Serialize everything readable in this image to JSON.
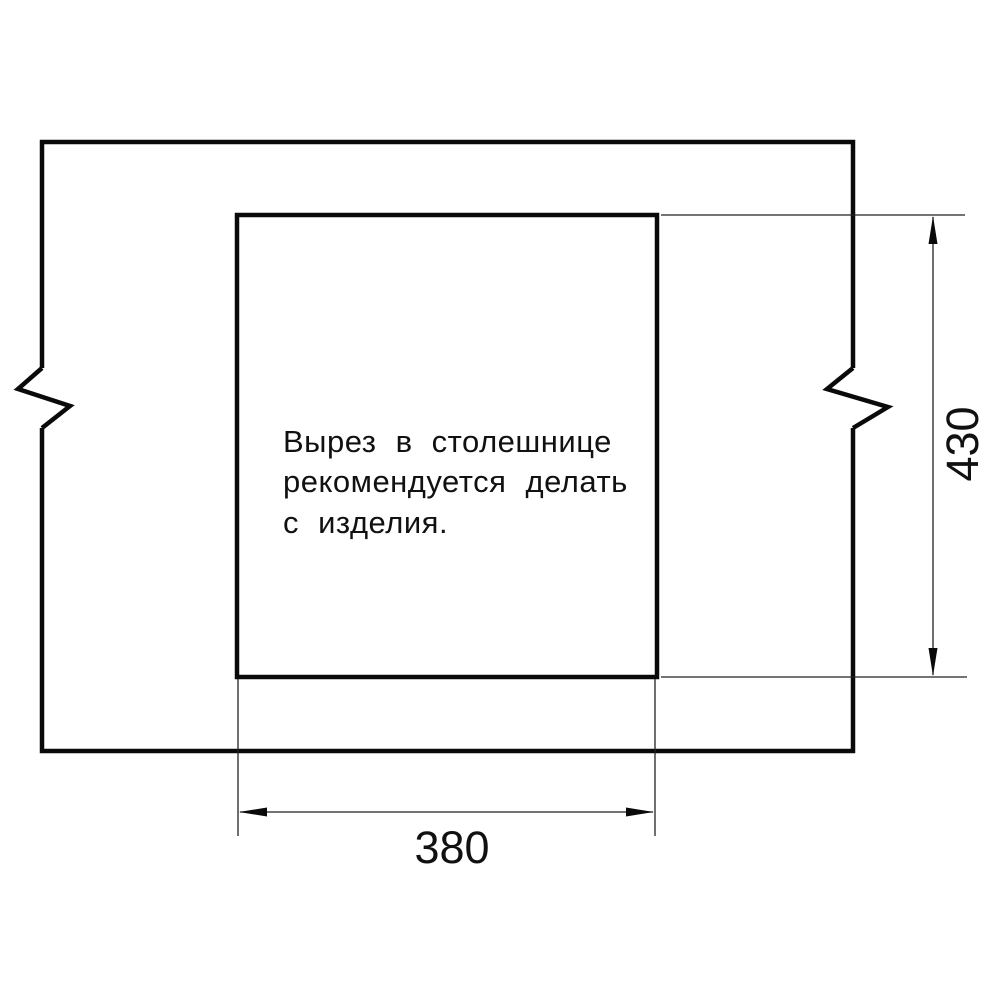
{
  "drawing": {
    "note": {
      "lines": {
        "0": "Вырез в столешнице",
        "1": "рекомендуется делать",
        "2": "с изделия."
      }
    },
    "dimensions": {
      "width_label": "380",
      "height_label": "430"
    },
    "colors": {
      "line": "#0a0a0a",
      "thin_line": "#222222",
      "text": "#111111",
      "background": "#ffffff"
    }
  }
}
